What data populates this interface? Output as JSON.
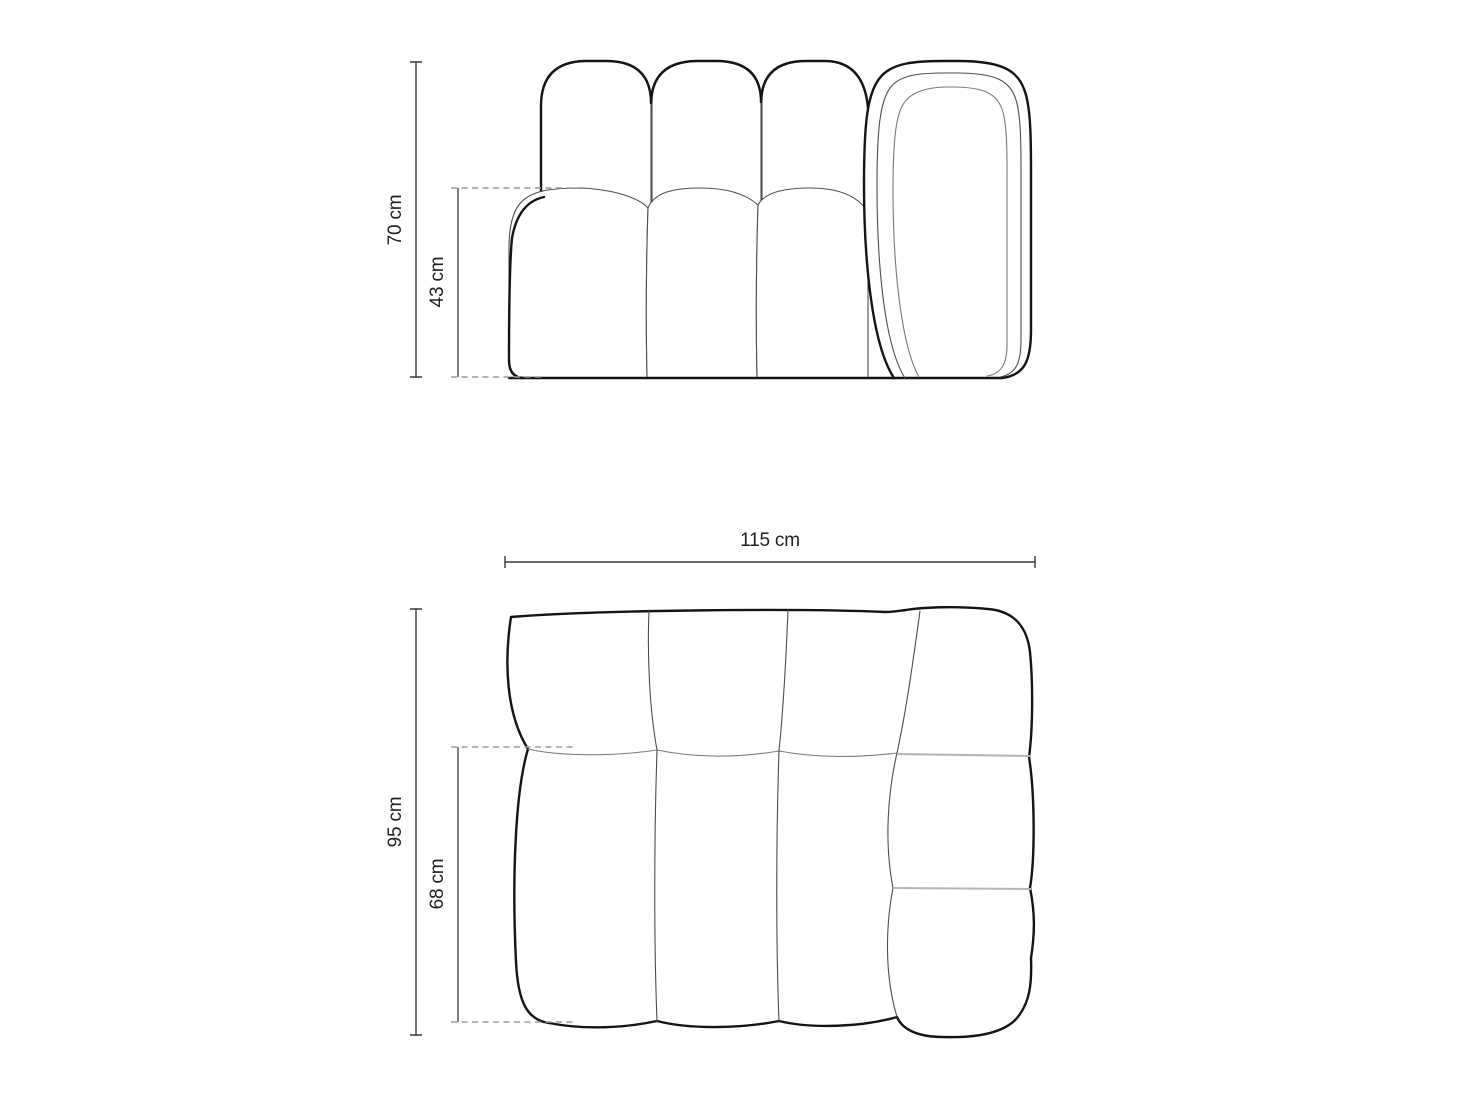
{
  "dims": {
    "front_total": "70 cm",
    "front_seat": "43 cm",
    "top_width": "115 cm",
    "top_depth": "95 cm",
    "top_seat": "68 cm"
  },
  "colors": {
    "background": "#ffffff",
    "line_bold": "#141414",
    "line_thin": "#4d4d4d",
    "line_medium": "#7a7a7a",
    "line_light": "#b5b5b5",
    "dimension": "#383838",
    "dimension_gray": "#808080",
    "dashed": "#9a9a9a",
    "label": "#1f1f1f"
  }
}
